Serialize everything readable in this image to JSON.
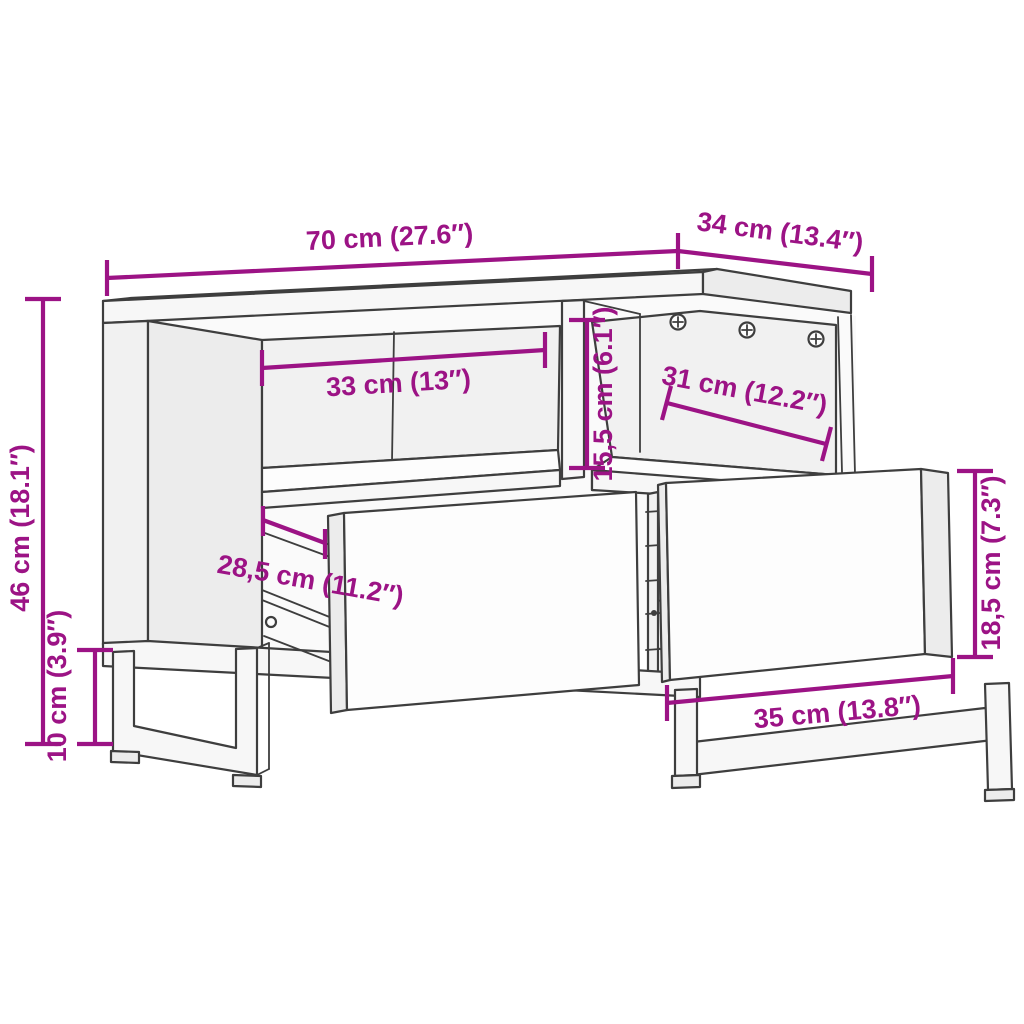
{
  "diagram": {
    "subject": "TV cabinet with two open compartments, two pulled-out drawers and U-shaped sled legs",
    "style": "technical line drawing with dimension annotations",
    "colors": {
      "background": "#ffffff",
      "outline": "#3e3e3e",
      "dimension_accent": "#9c1385",
      "face_light": "#fdfdfd",
      "face_shaded": "#ececec"
    },
    "dimensions": {
      "overall_width": {
        "label": "70 cm (27.6″)",
        "cm": "70",
        "inches": "27.6"
      },
      "overall_depth": {
        "label": "34 cm (13.4″)",
        "cm": "34",
        "inches": "13.4"
      },
      "body_height": {
        "label": "46 cm (18.1″)",
        "cm": "46",
        "inches": "18.1"
      },
      "leg_height": {
        "label": "10 cm (3.9″)",
        "cm": "10",
        "inches": "3.9"
      },
      "left_compartment_width": {
        "label": "33 cm (13″)",
        "cm": "33",
        "inches": "13"
      },
      "compartment_height": {
        "label": "15,5 cm (6.1″)",
        "cm": "15,5",
        "inches": "6.1"
      },
      "right_compartment_width": {
        "label": "31 cm (12.2″)",
        "cm": "31",
        "inches": "12.2"
      },
      "drawer_depth": {
        "label": "28,5 cm (11.2″)",
        "cm": "28,5",
        "inches": "11.2"
      },
      "drawer_front_height": {
        "label": "18,5 cm (7.3″)",
        "cm": "18,5",
        "inches": "7.3"
      },
      "leg_depth": {
        "label": "35 cm (13.8″)",
        "cm": "35",
        "inches": "13.8"
      }
    }
  }
}
